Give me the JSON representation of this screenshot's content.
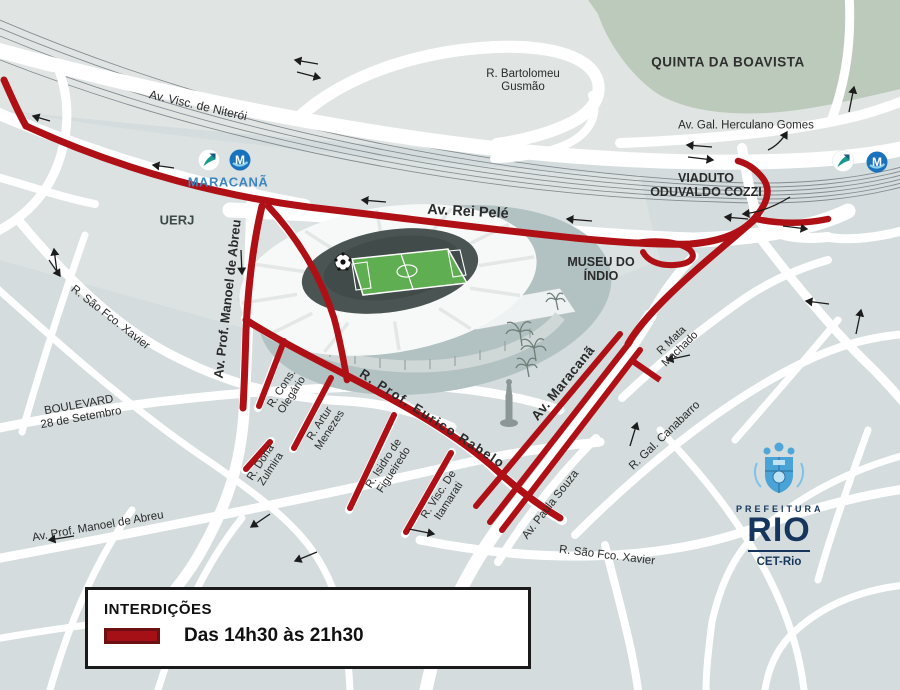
{
  "colors": {
    "closure": "#ae1015",
    "road": "#ffffff",
    "park": "#bccabb",
    "brand_navy": "#17365d",
    "metro_blue": "#1973bc",
    "train_teal": "#159a8c",
    "station_blue": "#3e86c0",
    "legend_swatch": "#a51016"
  },
  "station": {
    "name": "MARACANÃ",
    "metro_letter": "M"
  },
  "labels": {
    "visc_niteroi": "Av. Visc. de Niterói",
    "uerj": "UERJ",
    "bartolomeu": {
      "line1": "R. Bartolomeu",
      "line2": "Gusmão"
    },
    "quinta": "QUINTA DA BOAVISTA",
    "herculano": "Av. Gal. Herculano Gomes",
    "viaduto": {
      "line1": "VIADUTO",
      "line2": "ODUVALDO COZZI"
    },
    "rei_pele": "Av. Rei Pelé",
    "museu": {
      "line1": "MUSEU DO",
      "line2": "ÍNDIO"
    },
    "manoel_abreu_vert": "Av. Prof. Manoel de Abreu",
    "sfx_upper": "R. São Fco. Xavier",
    "boulevard": {
      "line1": "BOULEVARD",
      "line2": "28 de Setembro"
    },
    "cons_olegario": {
      "line1": "R. Cons.",
      "line2": "Olegário"
    },
    "artur_menezes": {
      "line1": "R. Artur",
      "line2": "Menezes"
    },
    "eurico_rabelo": "R. Prof. Eurico Rabelo",
    "isidro": {
      "line1": "R. Isidro de",
      "line2": "Figueiredo"
    },
    "itamarati": {
      "line1": "R. Visc. De",
      "line2": "Itamarati"
    },
    "dona_zulmira": {
      "line1": "R. Dona",
      "line2": "Zulmira"
    },
    "av_maracana": "Av. Maracanã",
    "mata_machado": {
      "line1": "R Mata",
      "line2": "Machado"
    },
    "paula_souza": "Av. Paula Souza",
    "canabarro": "R. Gal. Canabarro",
    "manoel_abreu_horiz": "Av. Prof. Manoel de Abreu",
    "sfx_lower": "R. São Fco. Xavier"
  },
  "legend": {
    "title": "INTERDIÇÕES",
    "entries": [
      {
        "label": "Das 14h30 às 21h30",
        "color": "#a51016"
      }
    ]
  },
  "logo": {
    "top": "PREFEITURA",
    "city": "RIO",
    "agency": "CET-Rio"
  }
}
